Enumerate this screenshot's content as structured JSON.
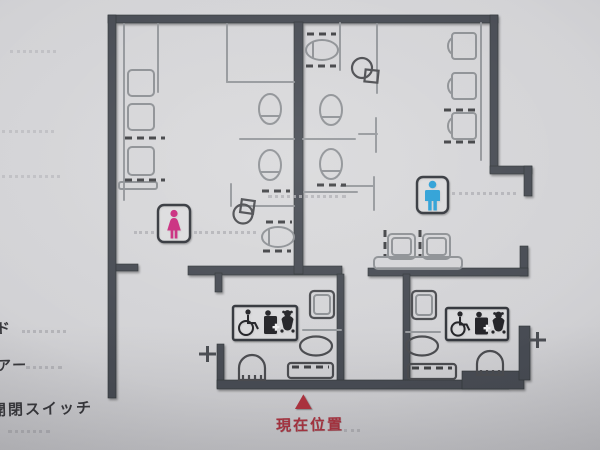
{
  "sign_type": "restroom-floor-map-tactile-sign",
  "left_labels": {
    "label1": "ド",
    "label2": "アー",
    "label3": "開閉スイッチ"
  },
  "marker": {
    "symbol": "▲",
    "label": "現在位置"
  },
  "colors": {
    "women_pink": "#c9297d",
    "men_blue": "#2b9fd6",
    "marker_red": "#b2333f",
    "wall_gray": "#474c52",
    "background_gray": "#cdced1",
    "icon_black": "#222326"
  },
  "icons": {
    "women_room_sign": "woman-icon",
    "men_room_sign": "man-icon",
    "accessible_sign_left": [
      "wheelchair-icon",
      "care-bed-icon",
      "baby-seat-icon"
    ],
    "accessible_sign_right": [
      "wheelchair-icon",
      "care-bed-icon",
      "baby-seat-icon"
    ],
    "door_switch_left": "plus-switch-icon",
    "door_switch_right": "plus-switch-icon",
    "location_marker": "current-location-triangle-icon"
  }
}
